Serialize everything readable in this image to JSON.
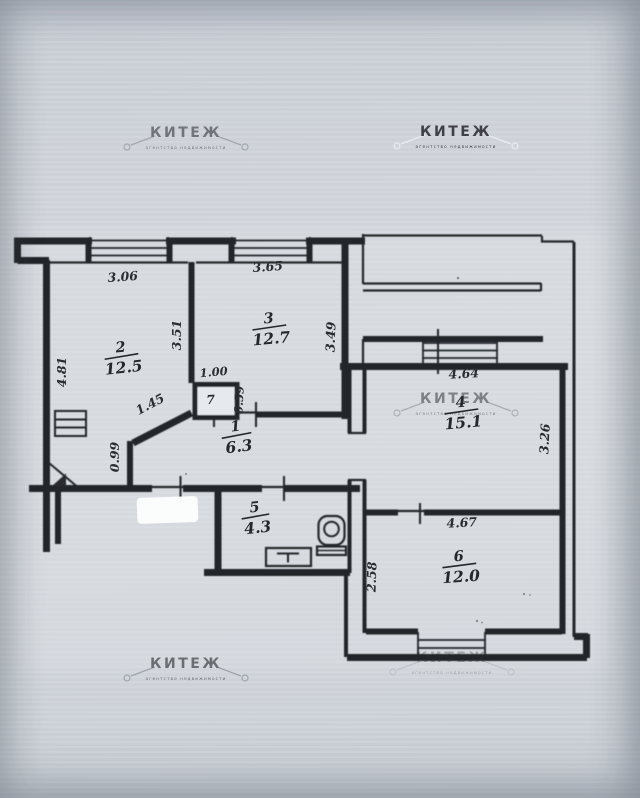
{
  "watermark": {
    "brand": "КИТЕЖ",
    "tagline": "агентство недвижимости"
  },
  "rooms": [
    {
      "number": "2",
      "area": "12.5"
    },
    {
      "number": "3",
      "area": "12.7"
    },
    {
      "number": "1",
      "area": "6.3"
    },
    {
      "number": "7",
      "area": ""
    },
    {
      "number": "4",
      "area": "15.1"
    },
    {
      "number": "5",
      "area": "4.3"
    },
    {
      "number": "6",
      "area": "12.0"
    }
  ],
  "dimensions": {
    "room2_top": "3.06",
    "room3_top": "3.65",
    "room2_left": "4.81",
    "room2_right": "3.51",
    "room3_right": "3.49",
    "closet_width": "1.00",
    "closet_depth": "0.59",
    "diagonal": "1.45",
    "vestibule_left": "0.99",
    "room4_top": "4.64",
    "room4_right": "3.26",
    "room4_bottom": "4.67",
    "room6_left": "2.58"
  }
}
